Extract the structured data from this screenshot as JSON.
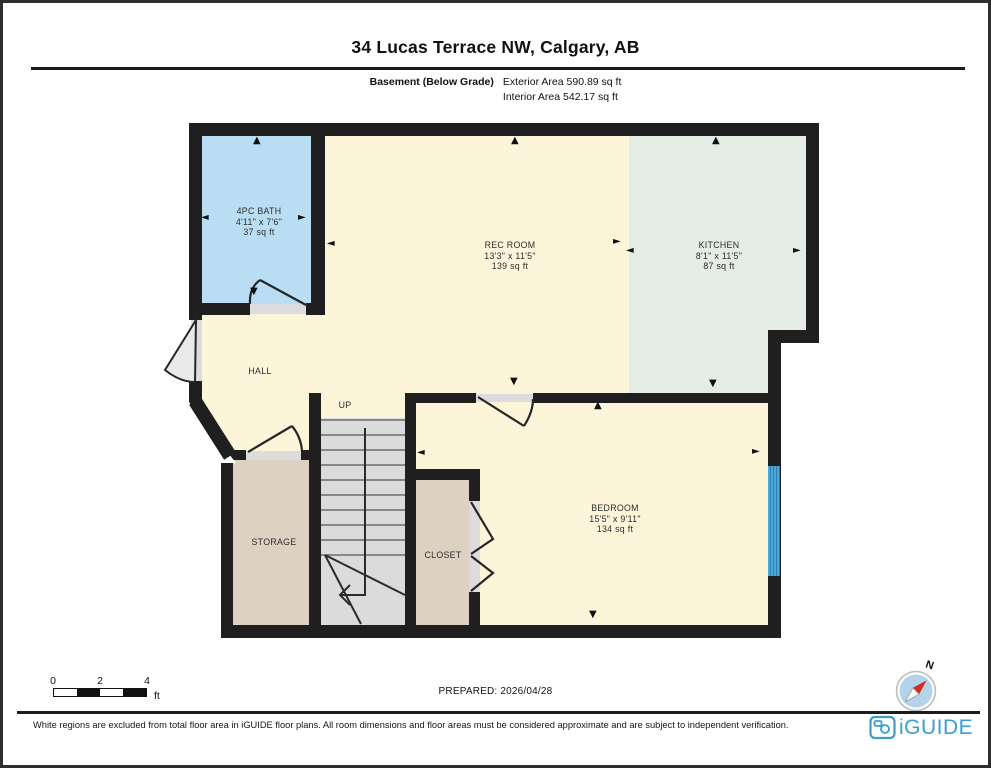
{
  "header": {
    "title": "34 Lucas Terrace NW, Calgary, AB",
    "floor_label": "Basement (Below Grade)",
    "exterior_area": "Exterior Area 590.89 sq ft",
    "interior_area": "Interior Area 542.17 sq ft"
  },
  "rooms": {
    "bath": {
      "name": "4PC BATH",
      "dims": "4'11\" x 7'6\"",
      "area": "37 sq ft"
    },
    "rec_room": {
      "name": "REC ROOM",
      "dims": "13'3\" x 11'5\"",
      "area": "139 sq ft"
    },
    "kitchen": {
      "name": "KITCHEN",
      "dims": "8'1\" x 11'5\"",
      "area": "87 sq ft"
    },
    "bedroom": {
      "name": "BEDROOM",
      "dims": "15'5\" x 9'11\"",
      "area": "134 sq ft"
    },
    "hall": {
      "name": "HALL"
    },
    "storage": {
      "name": "STORAGE"
    },
    "closet": {
      "name": "CLOSET"
    },
    "stairs": {
      "name": "UP"
    }
  },
  "icons": {
    "arrow_up": "▲",
    "arrow_down": "▼",
    "arrow_left": "◄",
    "arrow_right": "►"
  },
  "colors": {
    "room_cream": "#fcf5da",
    "bath_blue": "#b9def4",
    "kitchen_sage": "#e5ece6",
    "storage_tan": "#ddd2c2",
    "stairs_gray": "#dbdbdb",
    "wall_black": "#1f1f1f",
    "window_blue": "#4ba7d8",
    "brand_blue": "#3a9ecf"
  },
  "scale_bar": {
    "tick0": "0",
    "tick2": "2",
    "tick4": "4",
    "unit": "ft"
  },
  "prepared": "PREPARED: 2026/04/28",
  "compass": {
    "north_label": "N"
  },
  "footer": {
    "disclaimer": "White regions are excluded from total floor area in iGUIDE floor plans. All room dimensions and floor areas must be considered approximate and are subject to independent verification.",
    "brand": "iGUIDE"
  }
}
